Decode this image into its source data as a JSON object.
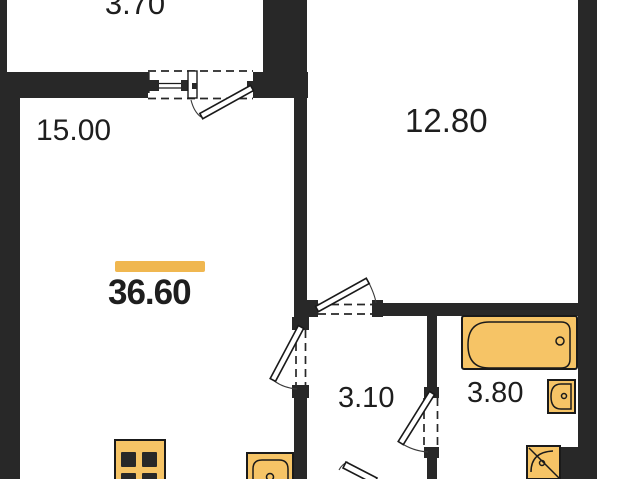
{
  "floor_plan": {
    "total_area_label": "36.60",
    "room_areas": {
      "balcony": "3.70",
      "living_room": "15.00",
      "bedroom": "12.80",
      "hallway": "3.10",
      "bathroom": "3.80"
    },
    "colors": {
      "wall": "#282828",
      "fixture": "#F6C466",
      "accent": "#F0B750",
      "outline": "#1A1A1A",
      "background": "#FFFFFF"
    },
    "glyphs": {
      "window": "balcony-window",
      "doors": [
        "balcony-door",
        "bedroom-door",
        "living-room-door",
        "bathroom-door",
        "entrance-door"
      ],
      "fixtures": [
        "bathtub",
        "wash-basin",
        "corner-basin",
        "stove",
        "kitchen-sink"
      ]
    }
  }
}
